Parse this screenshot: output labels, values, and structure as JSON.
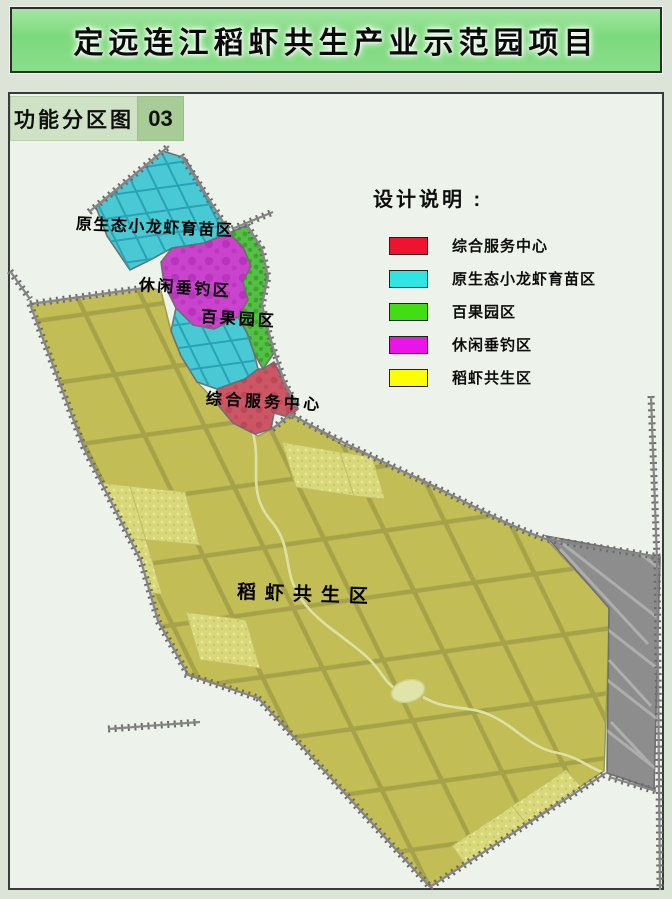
{
  "title": "定远连江稻虾共生产业示范园项目",
  "subtitle": {
    "label": "功能分区图",
    "number": "03"
  },
  "legend": {
    "title": "设计说明 :",
    "items": [
      {
        "label": "综合服务中心",
        "color": "#ee1430"
      },
      {
        "label": "原生态小龙虾育苗区",
        "color": "#30e4e4"
      },
      {
        "label": "百果园区",
        "color": "#42dd12"
      },
      {
        "label": "休闲垂钓区",
        "color": "#e814e8"
      },
      {
        "label": "稻虾共生区",
        "color": "#fdfd06"
      }
    ]
  },
  "map": {
    "labels": {
      "crayfish": "原生态小龙虾育苗区",
      "fishing": "休闲垂钓区",
      "orchard": "百果园区",
      "service": "综合服务中心",
      "rice": "稻虾共生区"
    },
    "zone_colors": {
      "rice_shrimp": "#c2bd55",
      "crayfish_nursery": "#48c9d4",
      "orchard": "#53bf44",
      "fishing": "#ca43cc",
      "service_center": "#cd5665",
      "outside_area": "#8d8d8d",
      "background": "#edf3ea"
    }
  }
}
